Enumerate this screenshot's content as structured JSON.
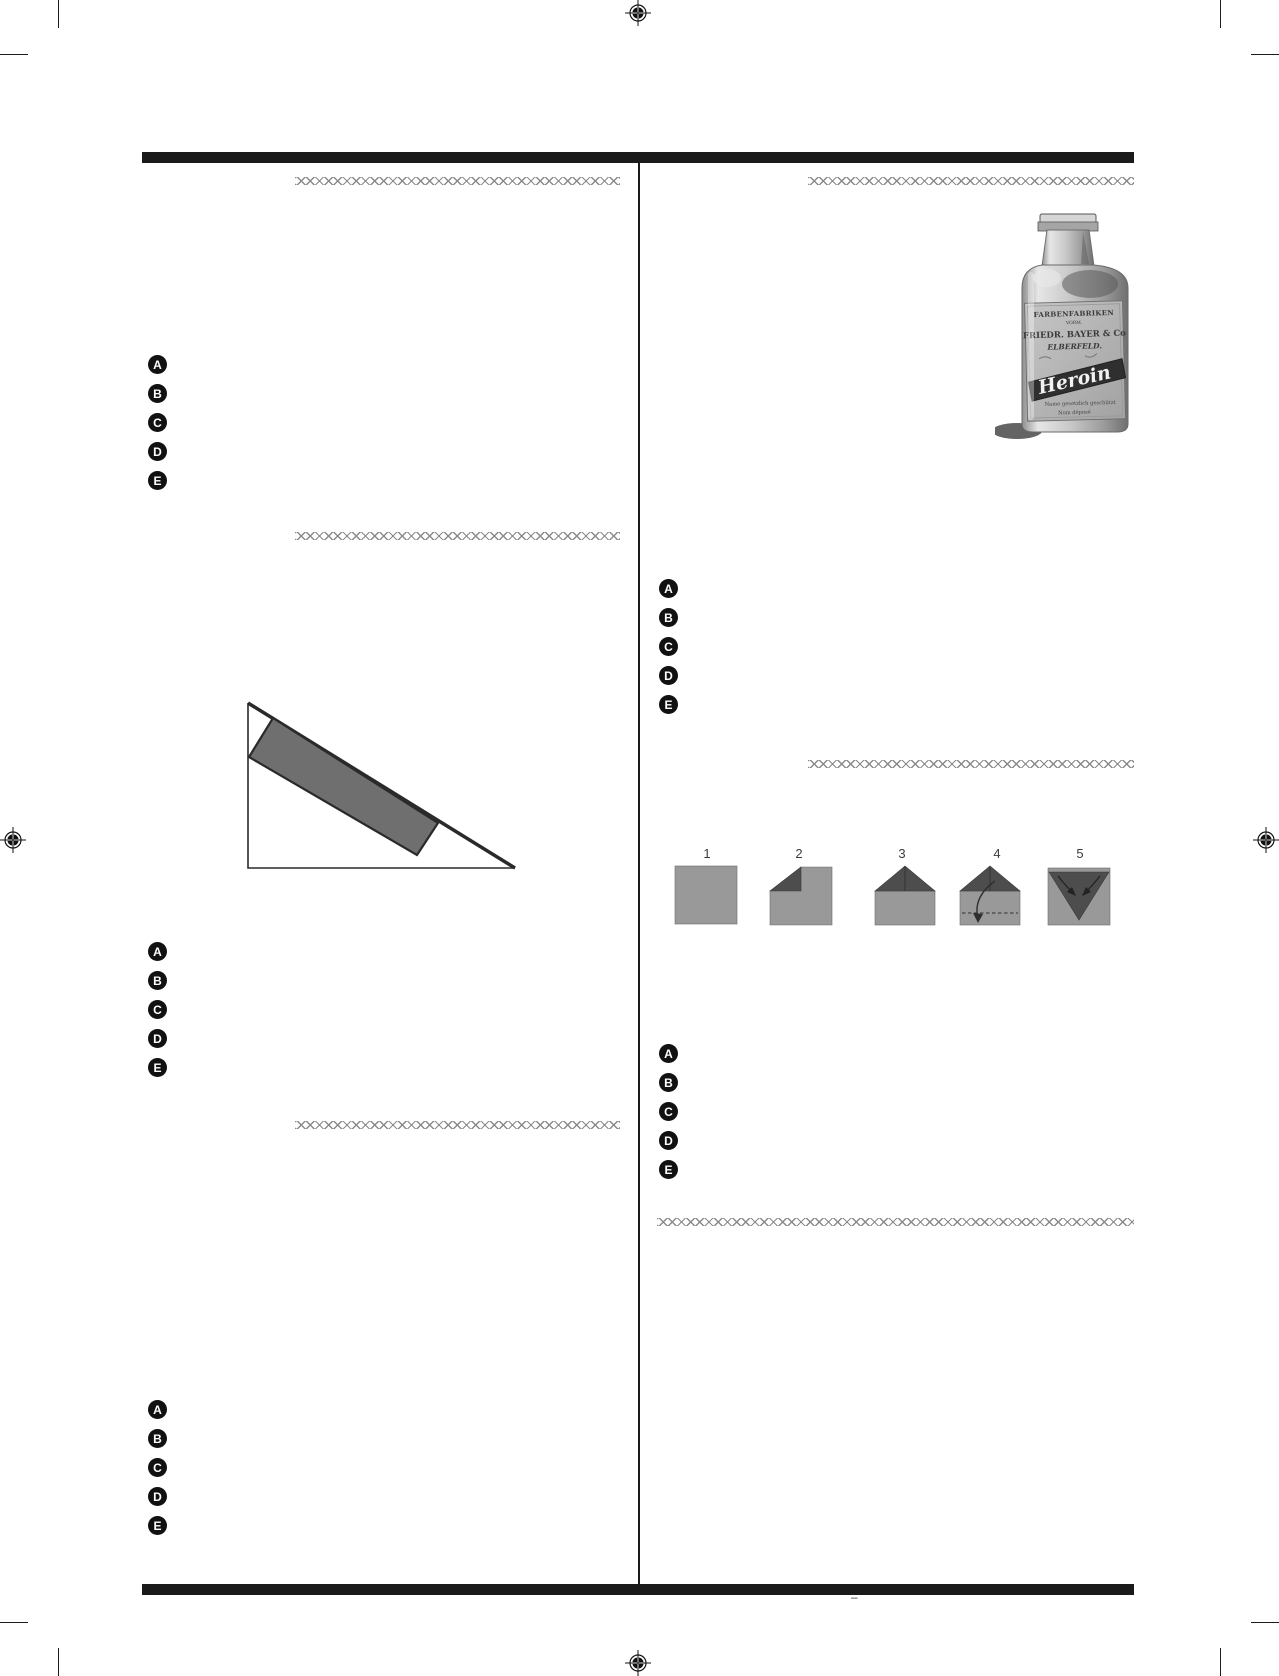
{
  "options": [
    "A",
    "B",
    "C",
    "D",
    "E"
  ],
  "folding": {
    "steps": [
      "1",
      "2",
      "3",
      "4",
      "5"
    ]
  },
  "bottle": {
    "line1": "FARBENFABRIKEN",
    "line2": "VORM.",
    "line3": "FRIEDR. BAYER & Co",
    "line4": "ELBERFELD.",
    "brand": "Heroin",
    "line5": "Name gesetzlich geschützt",
    "line6": "Nom déposé"
  },
  "footer": {
    "mark": "–"
  },
  "colors": {
    "rule": "#1a1a1a",
    "separator": "#8a8a8a",
    "option_circle": "#111111",
    "option_letter": "#ffffff",
    "plank": "#6f6f6f",
    "paper_light": "#999999",
    "paper_dark": "#4d4d4d"
  }
}
